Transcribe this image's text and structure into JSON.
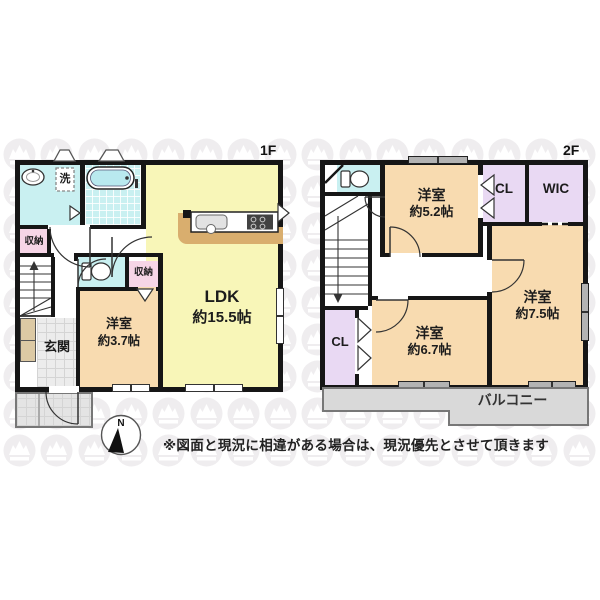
{
  "labels": {
    "floor1": "1F",
    "floor2": "2F"
  },
  "floor1": {
    "ldk_name": "LDK",
    "ldk_size": "約15.5帖",
    "bedroom_name": "洋室",
    "bedroom_size": "約3.7帖",
    "entrance": "玄関",
    "laundry": "洗",
    "storage_a": "収納",
    "storage_b": "収納"
  },
  "floor2": {
    "bedroom52_name": "洋室",
    "bedroom52_size": "約5.2帖",
    "bedroom67_name": "洋室",
    "bedroom67_size": "約6.7帖",
    "bedroom75_name": "洋室",
    "bedroom75_size": "約7.5帖",
    "closet_top": "CL",
    "closet_bottom": "CL",
    "wic": "WIC",
    "balcony": "バルコニー"
  },
  "compass": {
    "north": "N"
  },
  "note": {
    "disclaimer": "※図面と現況に相違がある場合は、現況優先とさせて頂きます"
  },
  "colors": {
    "wall": "#161616",
    "ldk_yellow": "#f8f6b8",
    "room_peach": "#f8dbb0",
    "wet_cyan": "#c9f0f1",
    "storage_pink": "#f6d5e6",
    "closet_lavender": "#e9d9f3",
    "balcony_gray": "#d9d9d9",
    "counter_tan": "#d9ae6e",
    "window_gray": "#b3b3b3"
  }
}
